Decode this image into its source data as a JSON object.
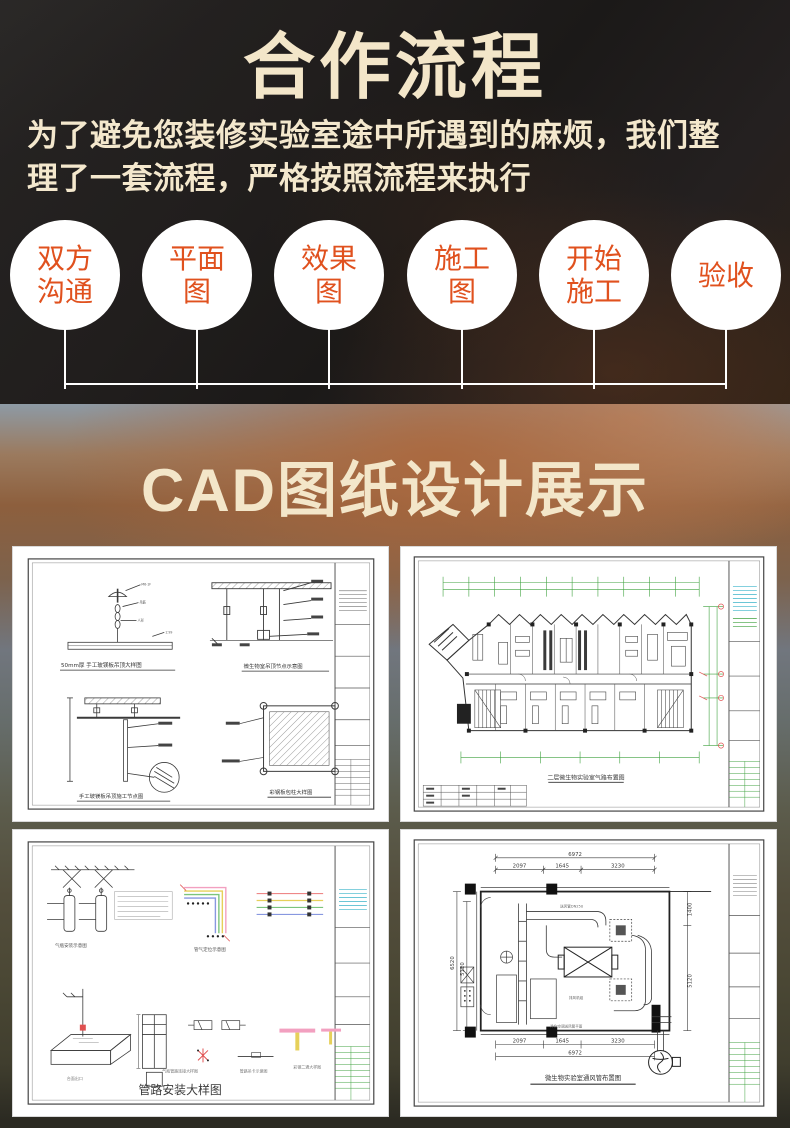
{
  "colors": {
    "hero_background": "#1f1c1b",
    "cream_text": "#f3e6c9",
    "step_text_orange": "#e0511e",
    "step_circle": "#ffffff",
    "cad_line": "#3a3a3a",
    "cad_green": "#3fa23f",
    "cad_red": "#e05050",
    "cad_cyan": "#3bb3c9"
  },
  "section_process": {
    "title": "合作流程",
    "description_line1": "为了避免您装修实验室途中所遇到的麻烦，我们整",
    "description_line2": "理了一套流程，严格按照流程来执行",
    "steps": [
      {
        "l1": "双方",
        "l2": "沟通"
      },
      {
        "l1": "平面",
        "l2": "图"
      },
      {
        "l1": "效果",
        "l2": "图"
      },
      {
        "l1": "施工",
        "l2": "图"
      },
      {
        "l1": "开始",
        "l2": "施工"
      },
      {
        "l1": "验收",
        "l2": ""
      }
    ]
  },
  "section_cad": {
    "title": "CAD图纸设计展示",
    "cards": {
      "detail_sheet": {
        "caption_a": "50mm厚 手工玻镁板吊顶大样图",
        "caption_b": "微生物室吊顶节点示意图",
        "caption_c": "手工玻镁板吊顶施工节点图",
        "caption_d": "彩钢板包柱大样图"
      },
      "floor_plan": {
        "caption": "二层微生物实验室气路布置图"
      },
      "pipe_detail": {
        "caption": "管路安装大样图",
        "caption_cylinder": "气瓶安装示意图",
        "caption_bundle": "管气定位示意图"
      },
      "vent_plan": {
        "caption": "微生物实验室通风管布置图",
        "dims": {
          "top_total": "6972",
          "top_a": "2097",
          "top_b": "1645",
          "top_c": "3230",
          "left_outer": "6520",
          "left_inner": "5120",
          "right_top": "1400",
          "right_bottom": "5120",
          "bottom_a": "2097",
          "bottom_b": "1645",
          "bottom_c": "3230",
          "bottom_total": "6972"
        }
      }
    }
  }
}
